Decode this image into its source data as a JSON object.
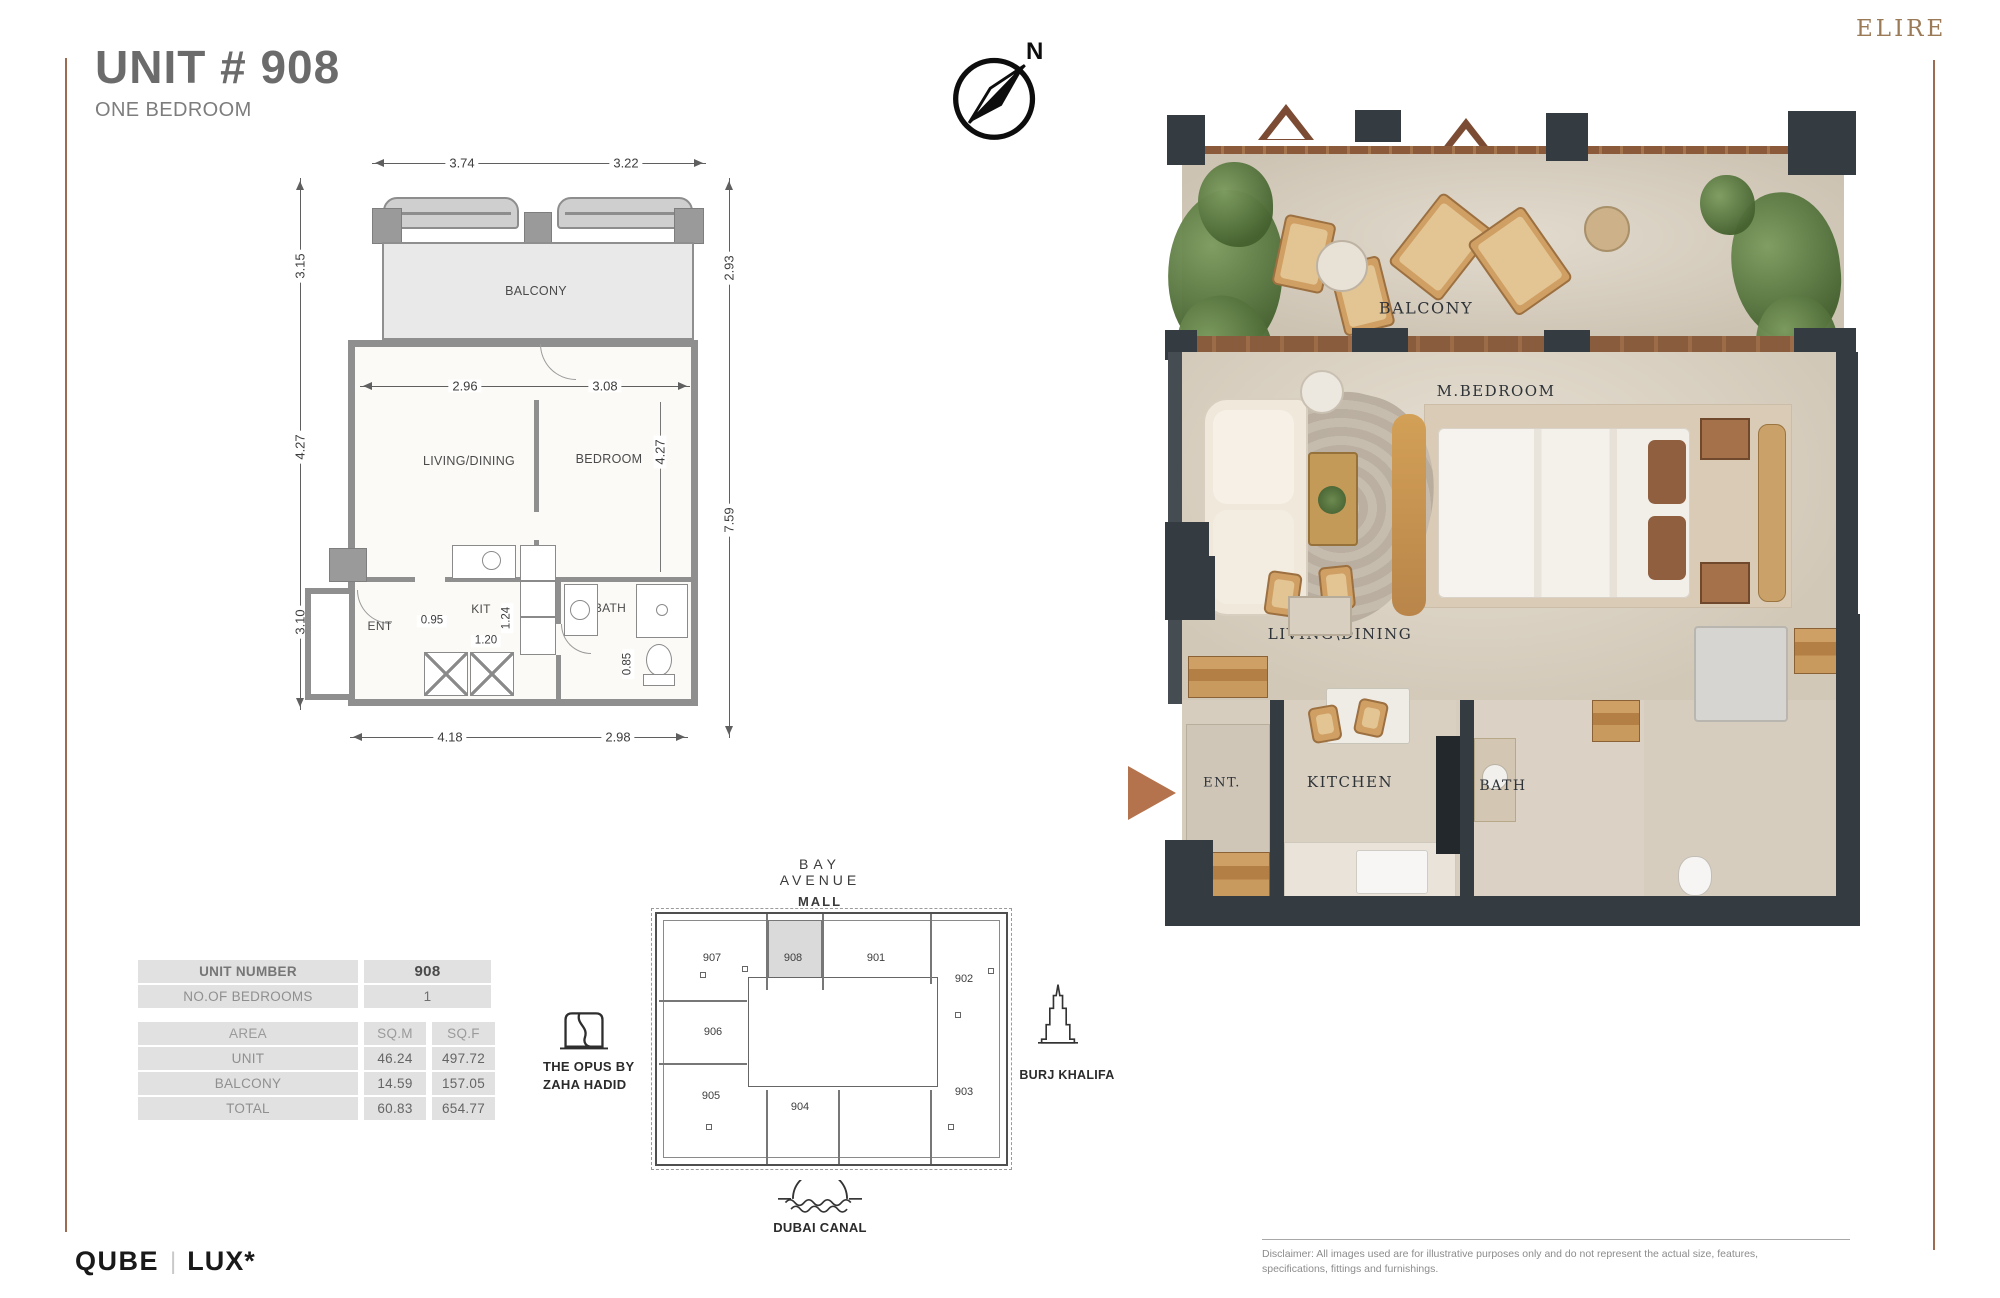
{
  "header": {
    "title": "UNIT # 908",
    "subtitle": "ONE BEDROOM",
    "brand": "ELIRE",
    "compass_n": "N"
  },
  "plan2d": {
    "dim_top_left": "3.74",
    "dim_top_right": "3.22",
    "dim_left_balcony": "3.15",
    "dim_left_living": "4.27",
    "dim_left_lower": "3.10",
    "dim_right_balcony": "2.93",
    "dim_right_unit": "7.59",
    "dim_inner_living": "2.96",
    "dim_inner_bedroom_w": "3.08",
    "dim_inner_bedroom_h": "4.27",
    "dim_kit_a": "0.95",
    "dim_kit_b": "1.24",
    "dim_kit_c": "1.20",
    "dim_bath": "0.85",
    "dim_bottom_left": "4.18",
    "dim_bottom_right": "2.98",
    "label_balcony": "BALCONY",
    "label_living": "LIVING/DINING",
    "label_bedroom": "BEDROOM",
    "label_ent": "ENT",
    "label_kit": "KIT",
    "label_bath": "BATH"
  },
  "render3d": {
    "label_balcony": "BALCONY",
    "label_mbedroom": "M.BEDROOM",
    "label_living": "LIVING\\DINING",
    "label_ent": "ENT.",
    "label_kitchen": "KITCHEN",
    "label_bath": "BATH"
  },
  "info_table": {
    "rows": [
      {
        "label": "UNIT NUMBER",
        "value": "908"
      },
      {
        "label": "NO.OF BEDROOMS",
        "value": "1"
      }
    ],
    "area_header": {
      "label": "AREA",
      "col1": "SQ.M",
      "col2": "SQ.F"
    },
    "area_rows": [
      {
        "label": "UNIT",
        "sqm": "46.24",
        "sqf": "497.72"
      },
      {
        "label": "BALCONY",
        "sqm": "14.59",
        "sqf": "157.05"
      },
      {
        "label": "TOTAL",
        "sqm": "60.83",
        "sqf": "654.77"
      }
    ]
  },
  "siteplan": {
    "mall_word1": "BAY",
    "mall_word2": "AVENUE",
    "mall_word3": "MALL",
    "units": {
      "u901": "901",
      "u902": "902",
      "u903": "903",
      "u904": "904",
      "u905": "905",
      "u906": "906",
      "u907": "907",
      "u908": "908"
    },
    "highlighted_unit": "908",
    "opus_line1": "THE OPUS BY",
    "opus_line2": "ZAHA HADID",
    "burj": "BURJ KHALIFA",
    "canal": "DUBAI CANAL"
  },
  "footer": {
    "logo_qube": "QUBE",
    "logo_divider": "|",
    "logo_lux": "LUX*",
    "disclaimer_line1": "Disclaimer: All images used are for illustrative purposes only and do not represent the actual size, features,",
    "disclaimer_line2": "specifications, fittings and furnishings."
  },
  "colors": {
    "accent_copper": "#b5734d",
    "brand_brown": "#9b7a58",
    "edge_line": "#9c6b52",
    "wall_gray": "#8f8f8f",
    "dark_wall": "#343b41",
    "balcony_fill": "#e9e9e9",
    "highlight_cell": "#dadada"
  }
}
